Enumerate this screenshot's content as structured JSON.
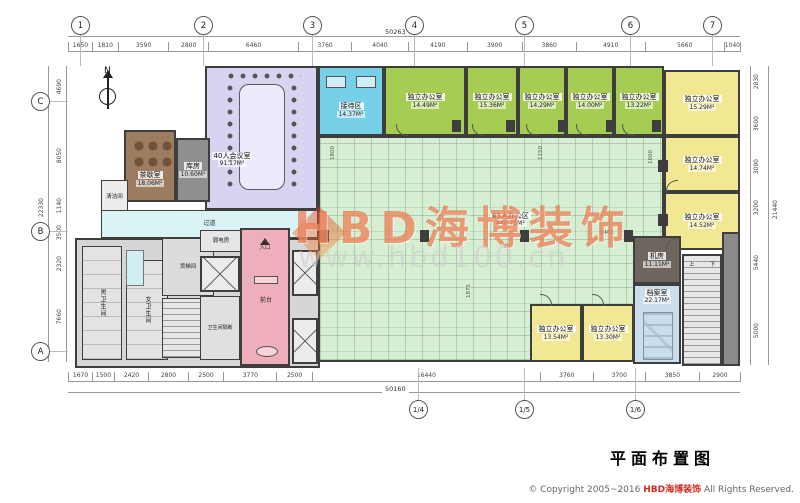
{
  "meta": {
    "title": "平面布置图",
    "copyright_prefix": "© Copyright 2005~2016 ",
    "copyright_brand": "HBD海博装饰",
    "copyright_suffix": " All Rights Reserved."
  },
  "watermark": {
    "brand": "HBD海博装饰",
    "url": "www.hbd100.cn"
  },
  "compass": {
    "north": "N"
  },
  "grid": {
    "top": [
      "1",
      "2",
      "3",
      "4",
      "5",
      "6",
      "7"
    ],
    "left": [
      "C",
      "B",
      "A"
    ],
    "bottom": [
      "1/4",
      "1/5",
      "1/6"
    ]
  },
  "dims": {
    "top": [
      "1650",
      "1810",
      "3590",
      "2800",
      "6460",
      "3760",
      "4040",
      "4190",
      "3900",
      "3860",
      "4910",
      "5660",
      "1040"
    ],
    "top_total": "50263",
    "bottom": [
      "1670",
      "1500",
      "2420",
      "2800",
      "2500",
      "3770",
      "2500",
      "16440",
      "3760",
      "3700",
      "3850",
      "2900"
    ],
    "bottom_total": "50160",
    "left": [
      "4690",
      "8050",
      "1140",
      "3500",
      "2320",
      "7660"
    ],
    "left_total": "22330",
    "right": [
      "2830",
      "3600",
      "3090",
      "3200",
      "5440",
      "5000"
    ],
    "right_total": "21440",
    "interior": [
      "1800",
      "1150",
      "1600",
      "1875",
      "1400"
    ]
  },
  "rooms": [
    {
      "n": "40人会议室",
      "a": "91.17M²"
    },
    {
      "n": "接待区",
      "a": "14.37M²"
    },
    {
      "n": "独立办公室",
      "a": "14.49M²"
    },
    {
      "n": "独立办公室",
      "a": "15.36M²"
    },
    {
      "n": "独立办公室",
      "a": "14.29M²"
    },
    {
      "n": "独立办公室",
      "a": "14.00M²"
    },
    {
      "n": "独立办公室",
      "a": "13.22M²"
    },
    {
      "n": "独立办公室",
      "a": "15.29M²"
    },
    {
      "n": "独立办公室",
      "a": "14.74M²"
    },
    {
      "n": "独立办公室",
      "a": "14.52M²"
    },
    {
      "n": "茶歇室",
      "a": "18.06M²"
    },
    {
      "n": "库房",
      "a": "10.60M²"
    },
    {
      "n": "65人办公区",
      "a": "440.75M²"
    },
    {
      "n": "独立办公室",
      "a": "13.54M²"
    },
    {
      "n": "独立办公室",
      "a": "13.30M²"
    },
    {
      "n": "机房",
      "a": "11.11M²"
    },
    {
      "n": "档案室",
      "a": "22.17M²"
    }
  ],
  "labels": {
    "corridor": "过道",
    "cleaning": "清洁间",
    "freight": "货梯间",
    "low_voltage": "弱电房",
    "male_wc": "男卫生间",
    "female_wc": "女卫生间",
    "wc_partition": "卫生间隔断",
    "front_desk": "前台",
    "entrance": "入口",
    "up": "上",
    "down": "下"
  },
  "colors": {
    "office_green": "#a6cc52",
    "open_office": "#d6efd2",
    "conference_lavender": "#d7d3f0",
    "reception_blue": "#76d0e8",
    "office_yellow": "#f2e894",
    "front_desk_pink": "#efafba",
    "tea_brown": "#9d7c60",
    "corridor_cyan": "#daf4f5",
    "watermark_orange": "#e85c28",
    "brand_red": "#d42a1e"
  }
}
